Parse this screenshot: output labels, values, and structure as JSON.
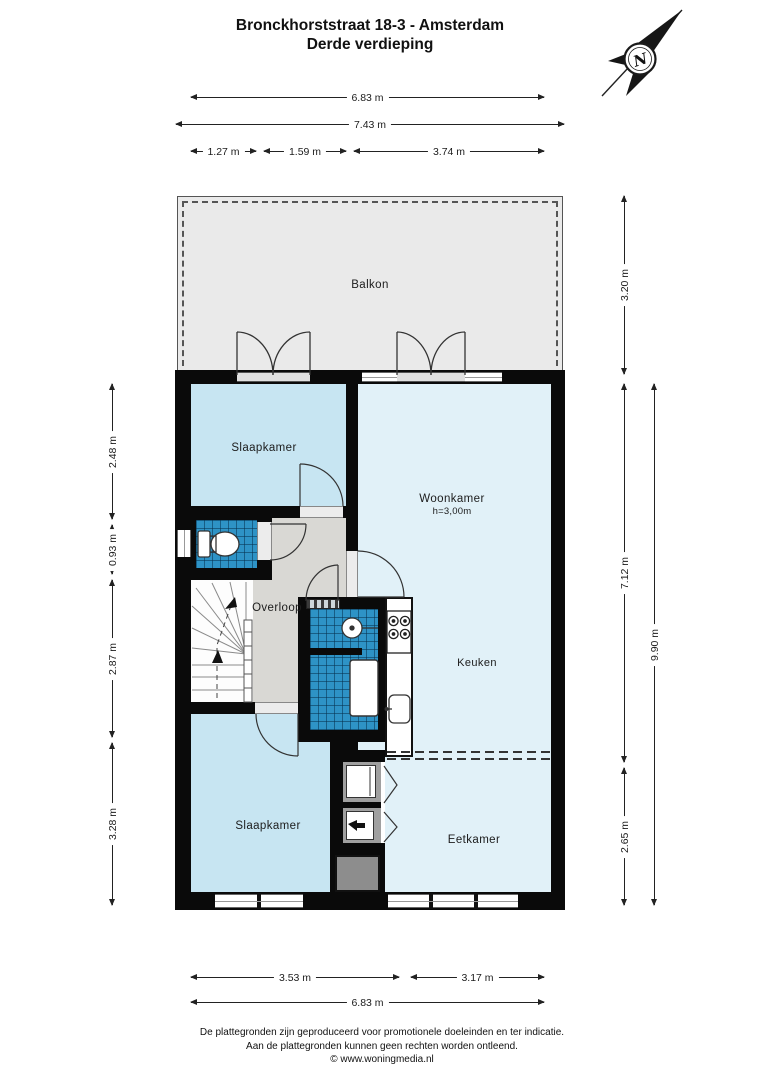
{
  "title": {
    "line1": "Bronckhorststraat 18-3 - Amsterdam",
    "line2": "Derde verdieping"
  },
  "compass": {
    "letter": "N"
  },
  "rooms": {
    "balkon": "Balkon",
    "slaapkamer_top": "Slaapkamer",
    "woonkamer": "Woonkamer",
    "woonkamer_height": "h=3,00m",
    "overloop": "Overloop",
    "keuken": "Keuken",
    "slaapkamer_bottom": "Slaapkamer",
    "eetkamer": "Eetkamer"
  },
  "dims": {
    "w683": "6.83 m",
    "w743": "7.43 m",
    "w127": "1.27 m",
    "w159": "1.59 m",
    "w374": "3.74 m",
    "h320": "3.20 m",
    "h712": "7.12 m",
    "h265": "2.65 m",
    "h990": "9.90 m",
    "h248": "2.48 m",
    "h093": "0.93 m",
    "h287": "2.87 m",
    "h328": "3.28 m",
    "w353": "3.53 m",
    "w317": "3.17 m",
    "w683b": "6.83 m"
  },
  "footer": {
    "line1": "De plattegronden zijn geproduceerd voor promotionele doeleinden en ter indicatie.",
    "line2": "Aan de plattegronden kunnen geen rechten worden ontleend.",
    "line3": "© www.woningmedia.nl"
  },
  "colors": {
    "wall": "#0a0a0a",
    "bedroom_fill": "#c7e5f2",
    "living_fill": "#e1f1f8",
    "tile_fill": "#2e93c6",
    "balcony_fill": "#eaeaea",
    "landing_fill": "#d9d8d4"
  }
}
